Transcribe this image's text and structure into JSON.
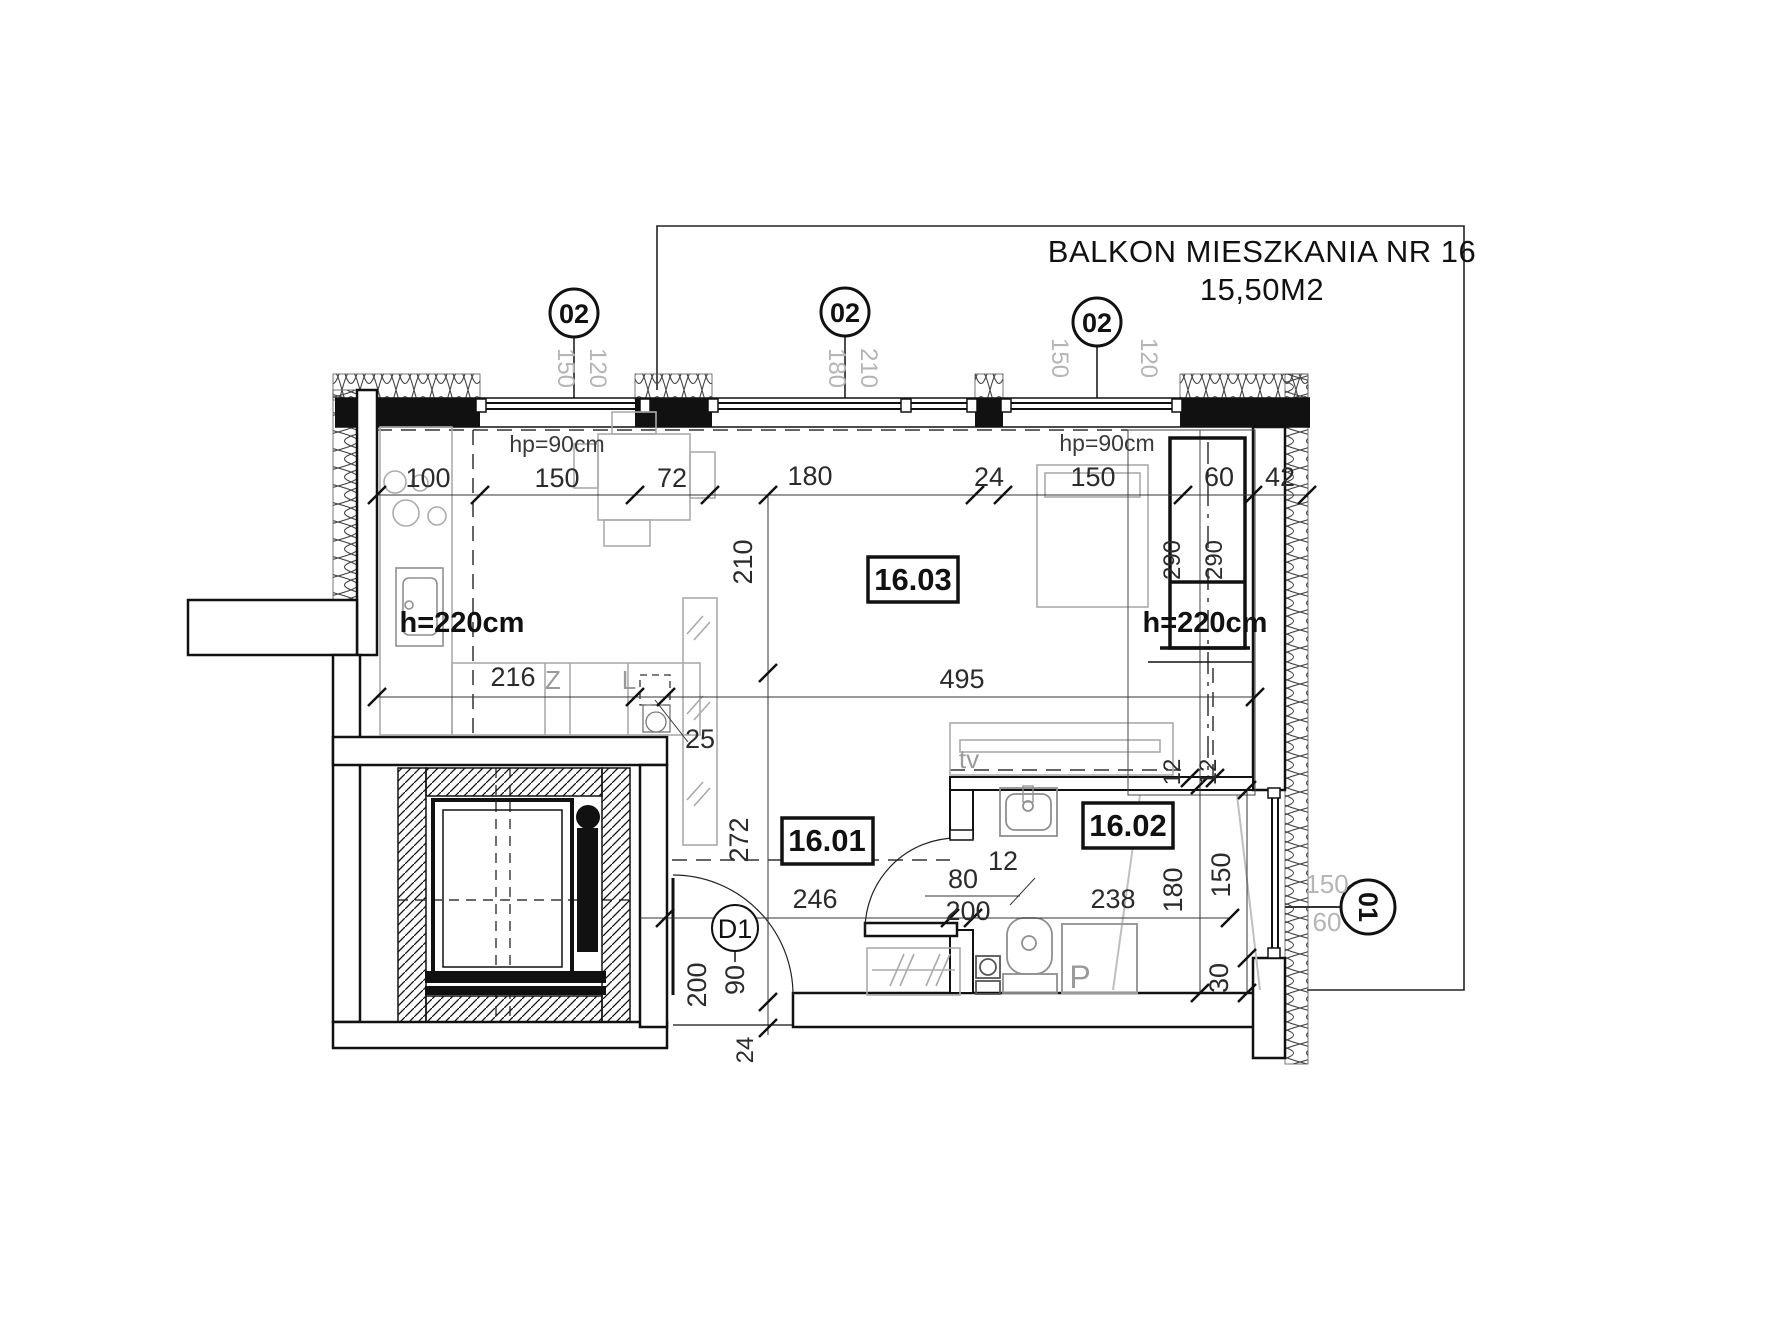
{
  "title": {
    "line1": "BALKON MIESZKANIA NR 16",
    "area": "15,50M2"
  },
  "rooms": {
    "main": "16.03",
    "hall": "16.01",
    "bathroom": "16.02"
  },
  "heights": {
    "left": "h=220cm",
    "right": "h=220cm",
    "parapet_left": "hp=90cm",
    "parapet_right": "hp=90cm"
  },
  "markers": {
    "window1": {
      "tag": "02",
      "dims": [
        "150",
        "120"
      ]
    },
    "window2": {
      "tag": "02",
      "dims": [
        "180",
        "210"
      ]
    },
    "window3": {
      "tag": "02",
      "dims": [
        "150",
        "120"
      ]
    },
    "window4": {
      "tag": "01",
      "dims": [
        "150",
        "60"
      ]
    },
    "entry_door": {
      "tag": "D1"
    }
  },
  "dimensions": {
    "top": [
      "100",
      "150",
      "72",
      "180",
      "24",
      "150",
      "60",
      "42"
    ],
    "mid": [
      "216",
      "25",
      "495",
      "210"
    ],
    "wardrobe": [
      "290",
      "290"
    ],
    "lower": [
      "246",
      "238",
      "272"
    ],
    "entry": [
      "200",
      "90",
      "24"
    ],
    "bath_door": [
      "80",
      "200",
      "12"
    ],
    "bath": [
      "180",
      "150",
      "12",
      "12",
      "30"
    ]
  },
  "fixtures": {
    "tv": "tv",
    "sink_symbol": "Z",
    "fridge_symbol": "L",
    "shower": "P"
  }
}
